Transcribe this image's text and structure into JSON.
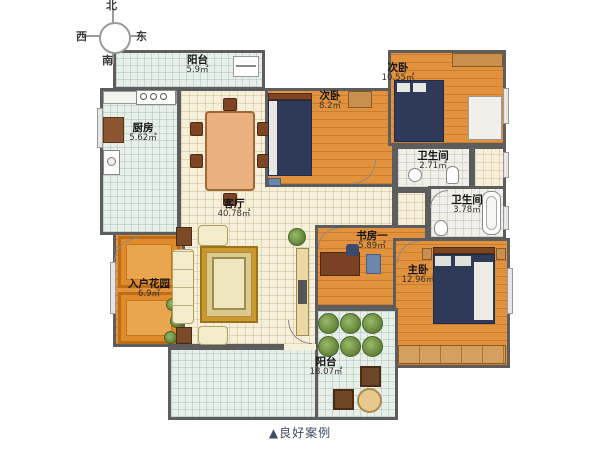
{
  "page": {
    "caption": "▲良好案例"
  },
  "compass": {
    "north": "北",
    "south": "南",
    "west": "西",
    "east": "东"
  },
  "rooms": {
    "balcony_top": {
      "name": "阳台",
      "area": "5.9㎡"
    },
    "kitchen": {
      "name": "厨房",
      "area": "5.62㎡"
    },
    "bedroom_mid": {
      "name": "次卧",
      "area": "8.2㎡"
    },
    "bedroom_right": {
      "name": "次卧",
      "area": "10.55㎡"
    },
    "bath_small": {
      "name": "卫生间",
      "area": "2.71㎡"
    },
    "bath_large": {
      "name": "卫生间",
      "area": "3.78㎡"
    },
    "living": {
      "name": "客厅",
      "area": "40.78㎡"
    },
    "study": {
      "name": "书房一",
      "area": "5.89㎡"
    },
    "master": {
      "name": "主卧",
      "area": "12.96㎡"
    },
    "garden": {
      "name": "入户花园",
      "area": "6.9㎡"
    },
    "balcony_bottom": {
      "name": "阳台",
      "area": "18.07㎡"
    }
  },
  "colors": {
    "wall": "#5d5d5d",
    "wood_floor": "#e2923c",
    "tile_mint": "#e8efe9",
    "tile_cream": "#f6efda",
    "bed": "#2e3a57",
    "rug_gold": "#c9992f",
    "rug_orange": "#e08a2c",
    "caption_text": "#3f4b63"
  }
}
